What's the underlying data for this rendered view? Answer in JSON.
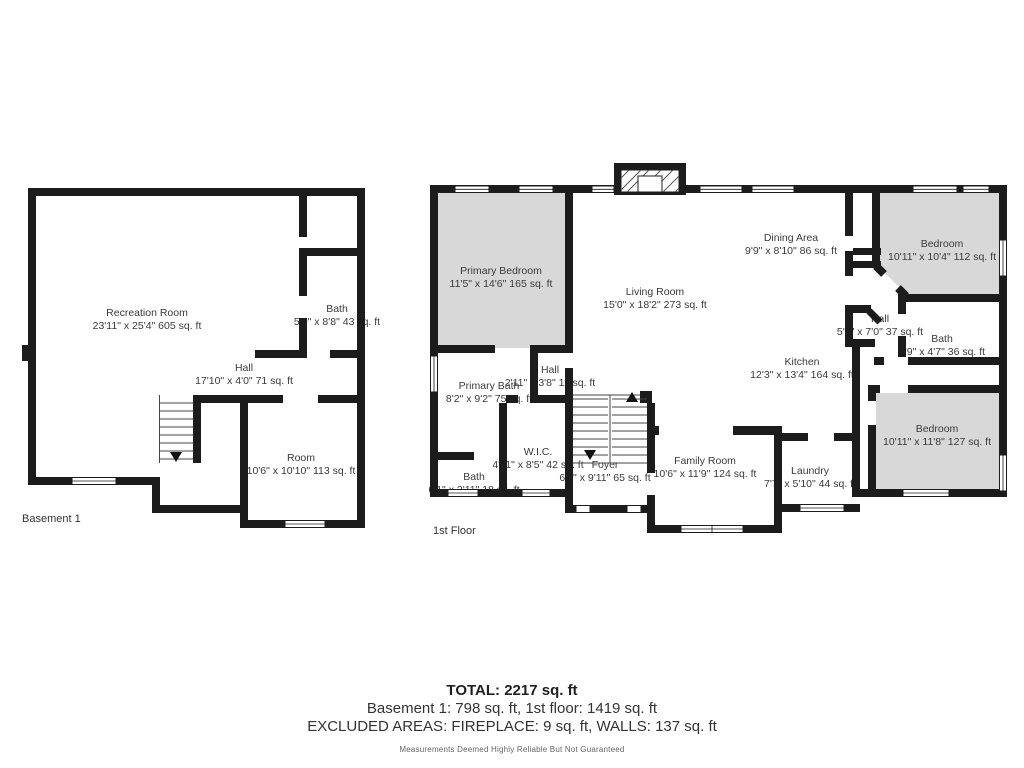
{
  "colors": {
    "wall": "#1c1c1c",
    "room_fill": "#d8d8d8",
    "label_text": "#3a3a3a"
  },
  "summary": {
    "total": "TOTAL: 2217 sq. ft",
    "breakdown": "Basement 1: 798 sq. ft, 1st floor: 1419 sq. ft",
    "excluded": "EXCLUDED AREAS: FIREPLACE: 9 sq. ft, WALLS: 137 sq. ft",
    "disclaimer": "Measurements Deemed Highly Reliable But Not Guaranteed"
  },
  "basement": {
    "floor_label": "Basement 1",
    "rooms": {
      "recreation_room": {
        "name": "Recreation Room",
        "dims": "23'11\" x 25'4\" 605 sq. ft"
      },
      "bath": {
        "name": "Bath",
        "dims": "5'0\" x 8'8\" 43 sq. ft"
      },
      "hall": {
        "name": "Hall",
        "dims": "17'10\" x 4'0\" 71 sq. ft"
      },
      "room": {
        "name": "Room",
        "dims": "10'6\" x 10'10\" 113 sq. ft"
      }
    }
  },
  "first_floor": {
    "floor_label": "1st Floor",
    "rooms": {
      "primary_bedroom": {
        "name": "Primary Bedroom",
        "dims": "11'5\" x 14'6\" 165 sq. ft"
      },
      "living_room": {
        "name": "Living Room",
        "dims": "15'0\" x 18'2\" 273 sq. ft"
      },
      "dining_area": {
        "name": "Dining Area",
        "dims": "9'9\" x 8'10\" 86 sq. ft"
      },
      "bedroom_upper": {
        "name": "Bedroom",
        "dims": "10'11\" x 10'4\" 112 sq. ft"
      },
      "hall_upper": {
        "name": "Hall",
        "dims": "5'3\" x 7'0\" 37 sq. ft"
      },
      "bath_upper": {
        "name": "Bath",
        "dims": "7'9\" x 4'7\" 36 sq. ft"
      },
      "kitchen": {
        "name": "Kitchen",
        "dims": "12'3\" x 13'4\" 164 sq. ft"
      },
      "primary_bath": {
        "name": "Primary Bath",
        "dims": "8'2\" x 9'2\" 75 sq. ft"
      },
      "hall_center": {
        "name": "Hall",
        "dims": "2'11\" x 3'8\" 11 sq. ft"
      },
      "wic": {
        "name": "W.I.C.",
        "dims": "4'11\" x 8'5\" 42 sq. ft"
      },
      "bath_lower": {
        "name": "Bath",
        "dims": "6'1\" x 2'11\" 18 sq. ft"
      },
      "foyer": {
        "name": "Foyer",
        "dims": "6'8\" x 9'11\" 65 sq. ft"
      },
      "family_room": {
        "name": "Family Room",
        "dims": "10'6\" x 11'9\" 124 sq. ft"
      },
      "laundry": {
        "name": "Laundry",
        "dims": "7'7\" x 5'10\" 44 sq. ft"
      },
      "bedroom_lower": {
        "name": "Bedroom",
        "dims": "10'11\" x 11'8\" 127 sq. ft"
      }
    }
  }
}
